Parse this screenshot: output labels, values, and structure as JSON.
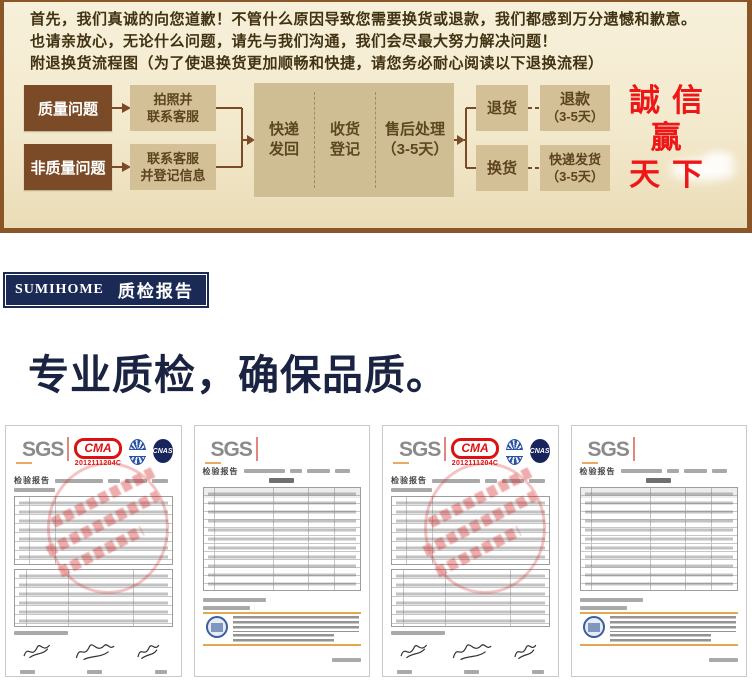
{
  "notice": {
    "lines": [
      "首先，我们真诚的向您道歉！不管什么原因导致您需要换货或退款，我们都感到万分遗憾和歉意。",
      "也请亲放心，无论什么问题，请先与我们沟通，我们会尽最大努力解决问题！",
      "附退换货流程图（为了使退换货更加顺畅和快捷，请您务必耐心阅读以下退换流程）"
    ]
  },
  "flow": {
    "quality_box": "质量问题",
    "non_quality_box": "非质量问题",
    "photo_box": {
      "line1": "拍照并",
      "line2": "联系客服"
    },
    "contact_box": {
      "line1": "联系客服",
      "line2": "并登记信息"
    },
    "process": {
      "col1": {
        "line1": "快递",
        "line2": "发回"
      },
      "col2": {
        "line1": "收货",
        "line2": "登记"
      },
      "col3": {
        "line1": "售后处理",
        "line2": "（3-5天）"
      }
    },
    "return_box": "退货",
    "refund_box": {
      "line1": "退款",
      "line2": "（3-5天）"
    },
    "exchange_box": "换货",
    "reship_box": {
      "line1": "快递发货",
      "line2": "（3-5天）"
    },
    "slogan": {
      "line1": "誠 信",
      "line2": "贏",
      "line3": "天 下"
    }
  },
  "report_banner": {
    "brand": "SUMIHOME",
    "title": "质检报告"
  },
  "headline": "专业质检，确保品质。",
  "certificates": {
    "sgs_logo": "SGS",
    "cma_logo": "CMA",
    "cma_code": "2012111204C",
    "cnas_logo": "CNAS",
    "report_label": "检验报告"
  },
  "colors": {
    "border_brown": "#8a5628",
    "dark_box_brown": "#7b4b28",
    "tan_box": "#d3c096",
    "slogan_red": "#ee1616",
    "banner_navy": "#1b2a55",
    "headline_navy": "#1a2342"
  }
}
